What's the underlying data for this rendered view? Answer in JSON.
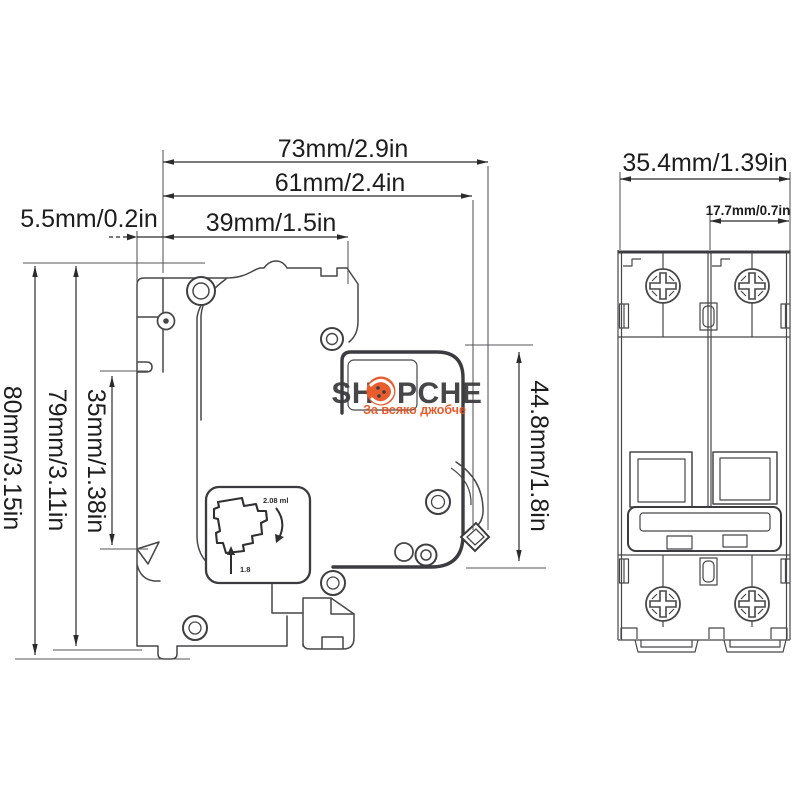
{
  "side_view": {
    "dim_width_total": "73mm/2.9in",
    "dim_width_body": "61mm/2.4in",
    "dim_width_front": "39mm/1.5in",
    "dim_rail_offset": "5.5mm/0.2in",
    "dim_height_total": "80mm/3.15in",
    "dim_height_body": "79mm/3.11in",
    "dim_rail_height": "35mm/1.38in",
    "dim_depth_upper": "44.8mm/1.8in",
    "label_box": {
      "text_top": "2.08 ml",
      "text_bottom": "1.8"
    }
  },
  "front_view": {
    "dim_width_total": "35.4mm/1.39in",
    "dim_pole_width": "17.7mm/0.7in"
  },
  "watermark": {
    "brand_left": "SH",
    "brand_right": "PCHE",
    "tagline": "За всяко джобче"
  },
  "colors": {
    "line": "#47474a",
    "dimension_text": "#1d1d1d",
    "accent": "#e8501e",
    "brand_text": "#3a3a3c",
    "background": "#ffffff"
  }
}
